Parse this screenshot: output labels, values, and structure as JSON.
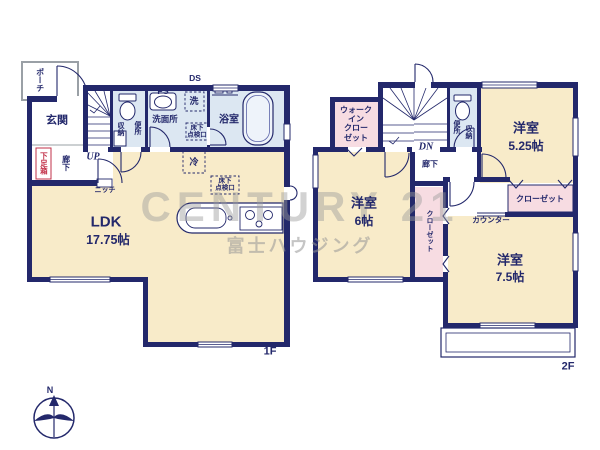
{
  "watermark": {
    "brand": "CENTURY 21",
    "company": "富士ハウジング"
  },
  "compass": {
    "north": "N"
  },
  "colors": {
    "wall": "#23286b",
    "room_cream": "#f8ebc9",
    "wet_blue": "#dce7f2",
    "closet_pink": "#f7dce2",
    "shoe_box_red": "#c23048",
    "watermark_gray": "#9b9b9b"
  },
  "floor1": {
    "tag": "1F",
    "porch": "ポーチ",
    "entrance": "玄関",
    "shoe_box": "下足箱",
    "hallway": "廊下",
    "stairs": "UP",
    "storage": "収納",
    "toilet": "便所",
    "pipe_space": "PS",
    "duct_space": "DS",
    "washroom": "洗面所",
    "washer": "洗",
    "bathroom": "浴室",
    "fridge": "冷",
    "niche": "ニッチ",
    "hatch": {
      "line1": "床下",
      "line2": "点検口"
    },
    "ldk": {
      "name": "LDK",
      "size": "17.75帖"
    }
  },
  "floor2": {
    "tag": "2F",
    "walk_in_closet": {
      "line1": "ウォーク",
      "line2": "イン",
      "line3": "クロー",
      "line4": "ゼット"
    },
    "stairs": "DN",
    "toilet": "便所",
    "storage": "収納",
    "hallway": "廊下",
    "room_525": {
      "name": "洋室",
      "size": "5.25帖"
    },
    "room_6": {
      "name": "洋室",
      "size": "6帖"
    },
    "room_75": {
      "name": "洋室",
      "size": "7.5帖"
    },
    "closet": "クローゼット",
    "closet_vertical": "クローゼット",
    "counter": "カウンター"
  }
}
